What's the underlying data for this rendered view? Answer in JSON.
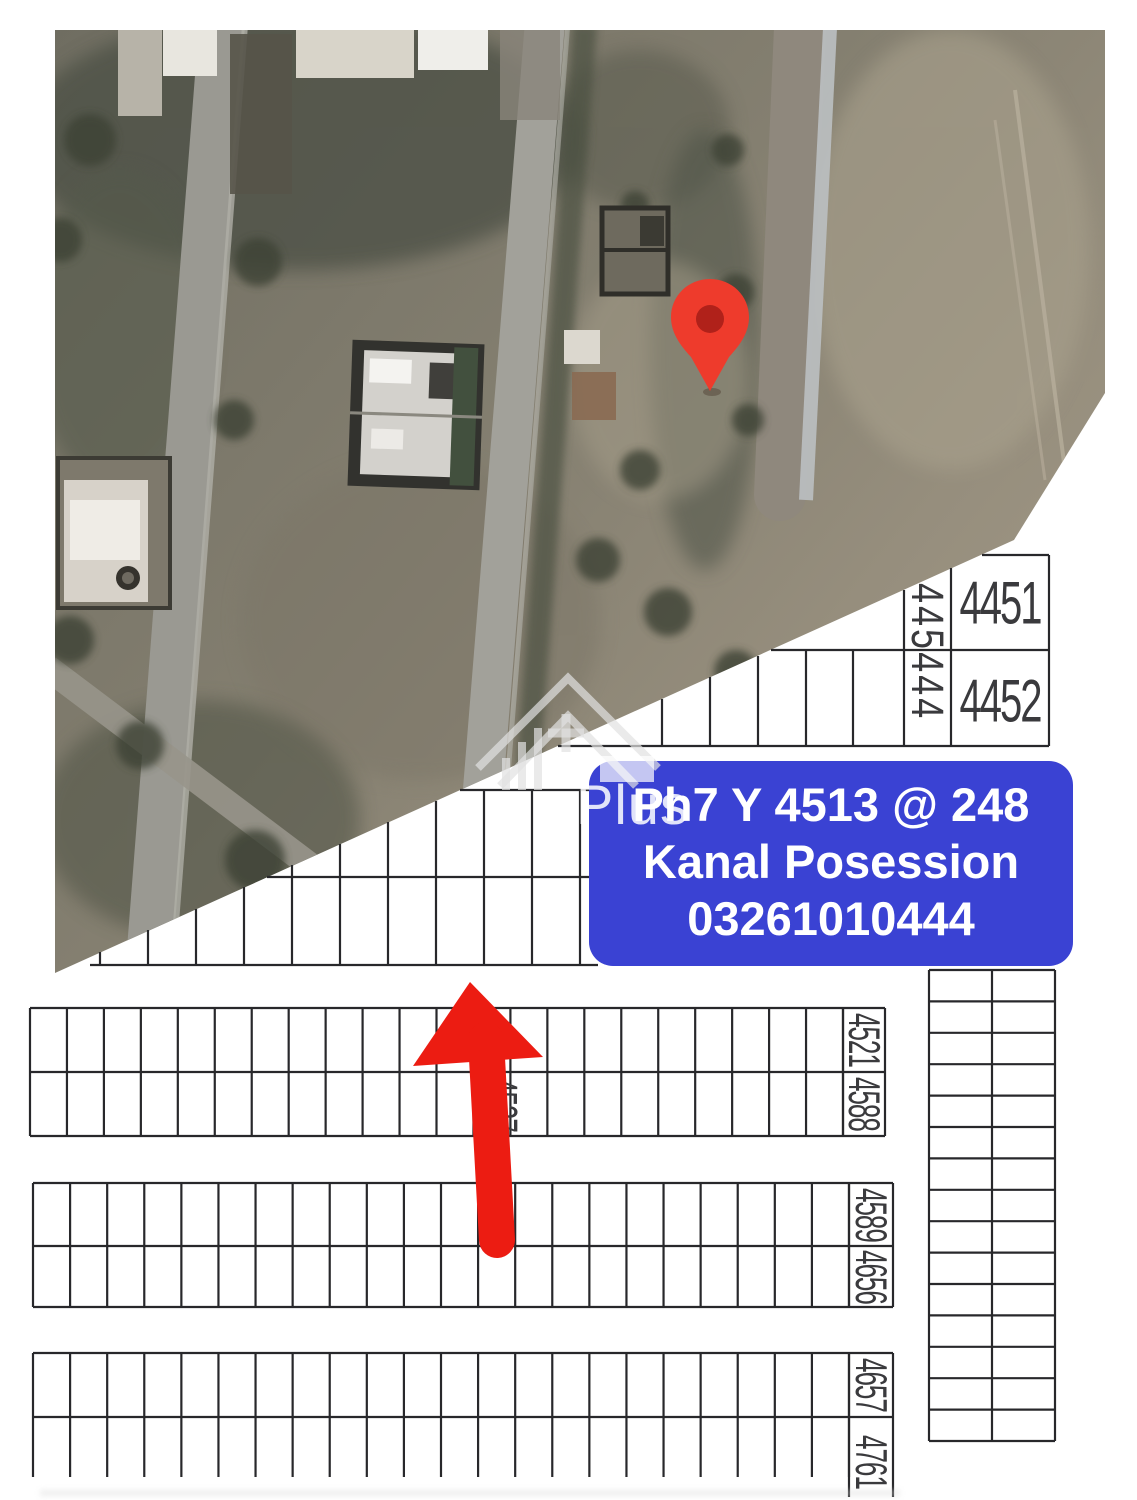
{
  "banner": {
    "lines": [
      "Ph7 Y 4513 @ 248",
      "Kanal Posession",
      "03261010444"
    ]
  },
  "watermark": {
    "text": "Plus"
  },
  "plot_map": {
    "top_right_block": {
      "vertical_label": "445444",
      "plots": [
        "4451",
        "4452"
      ]
    },
    "left_row_labels": [
      [
        "4521",
        "4588"
      ],
      [
        "4589",
        "4656"
      ],
      [
        "4657",
        "4761"
      ]
    ],
    "obscured_plot_label": "4537"
  },
  "colors": {
    "banner_blue": "#3a42d3",
    "marker_red": "#ec1c12",
    "pin_red": "#ee3b2c",
    "pin_inner_red": "#b0211a",
    "map_line": "#28282b"
  }
}
